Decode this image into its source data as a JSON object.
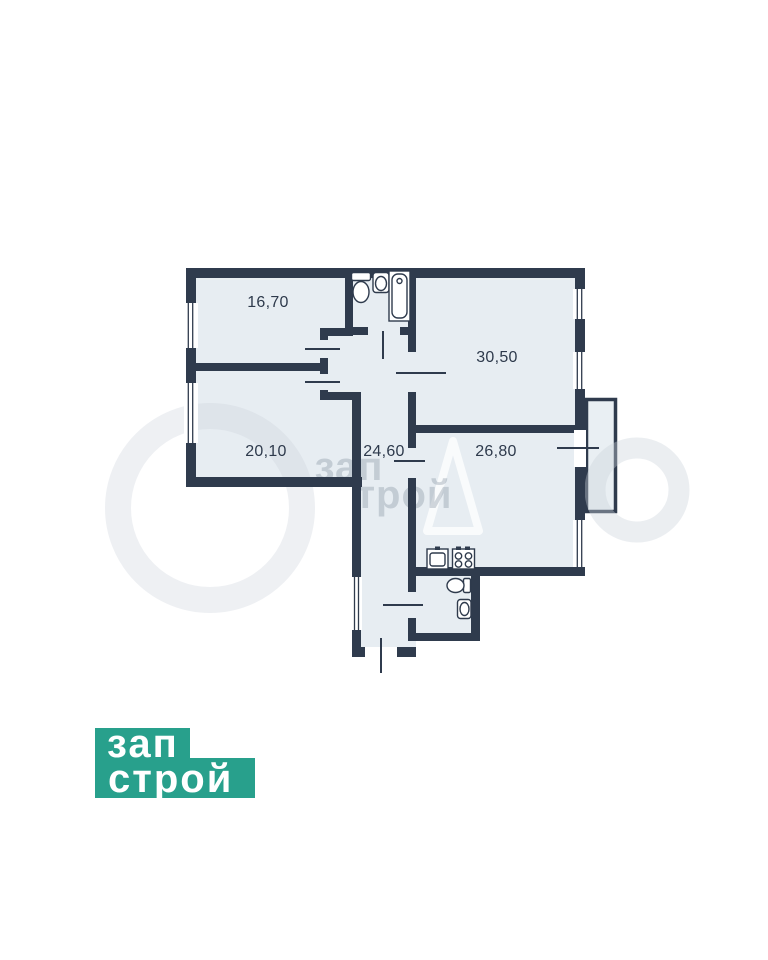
{
  "page": {
    "background_color": "#ffffff"
  },
  "floorplan": {
    "colors": {
      "wall": "#2F3B4D",
      "room_fill": "#E7EDF2",
      "balcony_fill": "#E9EFF3",
      "label": "#2E3A4C"
    },
    "rooms": [
      {
        "name": "room-top-left",
        "area_label": "16,70"
      },
      {
        "name": "room-top-right",
        "area_label": "30,50"
      },
      {
        "name": "room-bottom-left",
        "area_label": "20,10"
      },
      {
        "name": "hallway",
        "area_label": "24,60"
      },
      {
        "name": "room-bottom-right",
        "area_label": "26,80"
      }
    ],
    "fixtures": [
      "toilet",
      "washbasin",
      "bathtub",
      "kitchen-sink",
      "stove",
      "wc-toilet",
      "wc-washbasin"
    ],
    "features": [
      "balcony",
      "windows",
      "interior-doors",
      "entry-door"
    ]
  },
  "watermark": {
    "line1": "зап",
    "line2": "трой"
  },
  "logo": {
    "line1": "зап",
    "line2": "строй",
    "background_color": "#28A08C",
    "text_color": "#ffffff"
  }
}
